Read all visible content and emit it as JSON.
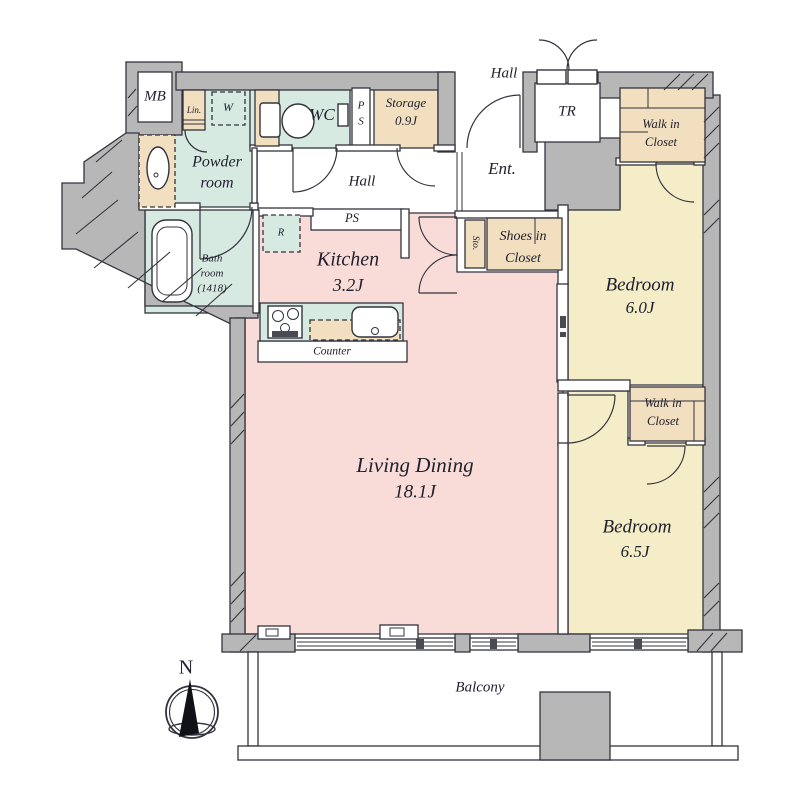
{
  "floor_plan": {
    "compass": {
      "north_label": "N"
    },
    "balcony": {
      "label": "Balcony"
    },
    "outside": {
      "hall_label": "Hall"
    },
    "rooms": {
      "living_dining": {
        "name": "Living Dining",
        "size": "18.1J"
      },
      "kitchen": {
        "name": "Kitchen",
        "size": "3.2J"
      },
      "bedroom_1": {
        "name": "Bedroom",
        "size": "6.0J"
      },
      "bedroom_2": {
        "name": "Bedroom",
        "size": "6.5J"
      },
      "powder_room": {
        "line1": "Powder",
        "line2": "room"
      },
      "bath_room": {
        "line1": "Bath",
        "line2": "room",
        "line3": "(1418)"
      },
      "wc": {
        "name": "WC"
      },
      "storage": {
        "name": "Storage",
        "size": "0.9J"
      },
      "hall": {
        "name": "Hall"
      },
      "entrance": {
        "name": "Ent."
      },
      "trunk_room": {
        "name": "TR"
      },
      "walk_in_closet_1": {
        "line1": "Walk in",
        "line2": "Closet"
      },
      "walk_in_closet_2": {
        "line1": "Walk in",
        "line2": "Closet"
      },
      "shoes_in_closet": {
        "line1": "Shoes in",
        "line2": "Closet"
      }
    },
    "features": {
      "meter_box": "MB",
      "linen": "Lin.",
      "washer": "W",
      "refrigerator": "R",
      "pipe_space_vertical_p": "P",
      "pipe_space_vertical_s": "S",
      "pipe_space": "PS",
      "small_storage": "Sto.",
      "counter": "Counter"
    },
    "colors": {
      "ldk": "#f9dcd8",
      "wet": "#d7eae2",
      "closet": "#f1dfbf",
      "bedroom": "#f5edc8",
      "wall": "#b7b7b7",
      "line": "#33333d",
      "text": "#20202e"
    }
  }
}
